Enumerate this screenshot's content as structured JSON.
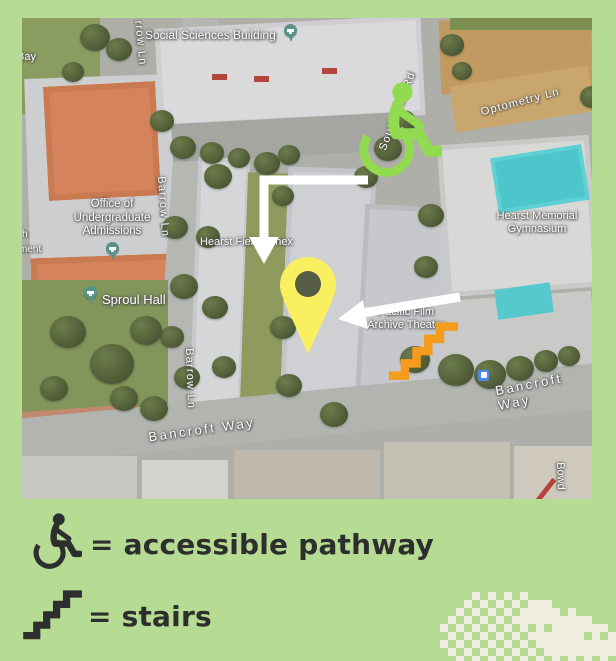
{
  "title_context": "campus accessibility map flyer",
  "map": {
    "place_labels": [
      {
        "name": "social-sciences-building",
        "text": "Social Sciences Building"
      },
      {
        "name": "bay-fragment",
        "text": "Bay"
      },
      {
        "name": "office-of-undergraduate-admissions",
        "text": "Office of\nUndergraduate\nAdmissions"
      },
      {
        "name": "sproul-hall",
        "text": "Sproul Hall"
      },
      {
        "name": "hearst-field-annex",
        "text": "Hearst Field Annex"
      },
      {
        "name": "pacific-film-archive-theater",
        "text": "Pacific Film\nArchive Theater"
      },
      {
        "name": "hearst-memorial-gymnasium",
        "text": "Hearst Memorial\nGymnasium"
      },
      {
        "name": "bowditch-fragment",
        "text": "Bowd"
      },
      {
        "name": "left-edge-fragment-1",
        "text": "h"
      },
      {
        "name": "left-edge-fragment-2",
        "text": "ment"
      }
    ],
    "street_labels": [
      {
        "name": "barrow-ln-top",
        "text": "rrow Ln"
      },
      {
        "name": "barrow-ln-mid",
        "text": "Barrow Ln"
      },
      {
        "name": "barrow-ln-low",
        "text": "Barrow Ln"
      },
      {
        "name": "south-hall-rd",
        "text": "South Hall Rd"
      },
      {
        "name": "optometry-ln",
        "text": "Optometry Ln"
      },
      {
        "name": "bancroft-way-west",
        "text": "Bancroft Way"
      },
      {
        "name": "bancroft-way-east",
        "text": "Bancroft Way"
      }
    ],
    "markers": {
      "accessible_pathway_start": "wheelchair-icon",
      "destination": "yellow-map-pin-icon",
      "stairs": "stairs-icon",
      "bus_stop": "bus-icon",
      "place_pins": "graduation-cap-pin-icon",
      "route_arrow_count": 2
    }
  },
  "legend": {
    "items": [
      {
        "icon": "wheelchair-icon",
        "label": "= accessible pathway"
      },
      {
        "icon": "stairs-icon",
        "label": "= stairs"
      }
    ]
  },
  "decoration": {
    "name": "pixel-art-dither",
    "color": "#f1ede1",
    "rows": [
      "....#.#.#.#...........",
      "...#.#.#.#.###........",
      "..#.#.#.#.#####.#.....",
      ".#.#.#.#.##########...",
      "#.#.#.#.#.#.#.#######.",
      ".#.#.#.#.#.#######.#.#",
      "#.#.#.#.#.#.##########",
      ".#.#.#.#.#.#.#########",
      "..#.#.#.#.#.#.#.#.#.#."
    ]
  },
  "colors": {
    "background_green": "#b6db92",
    "legend_ink": "#2d2f2e",
    "accessible_icon_green": "#92da4f",
    "stairs_orange": "#f59b1e",
    "destination_pin_yellow": "#f8ef61",
    "pin_hole_olive": "#575c44",
    "route_arrow_white": "#ffffff",
    "bus_blue": "#4a87ee",
    "place_pin_teal": "#5a9288",
    "pool_teal": "#4cc6cb",
    "pixel_cream": "#f1ede1"
  }
}
